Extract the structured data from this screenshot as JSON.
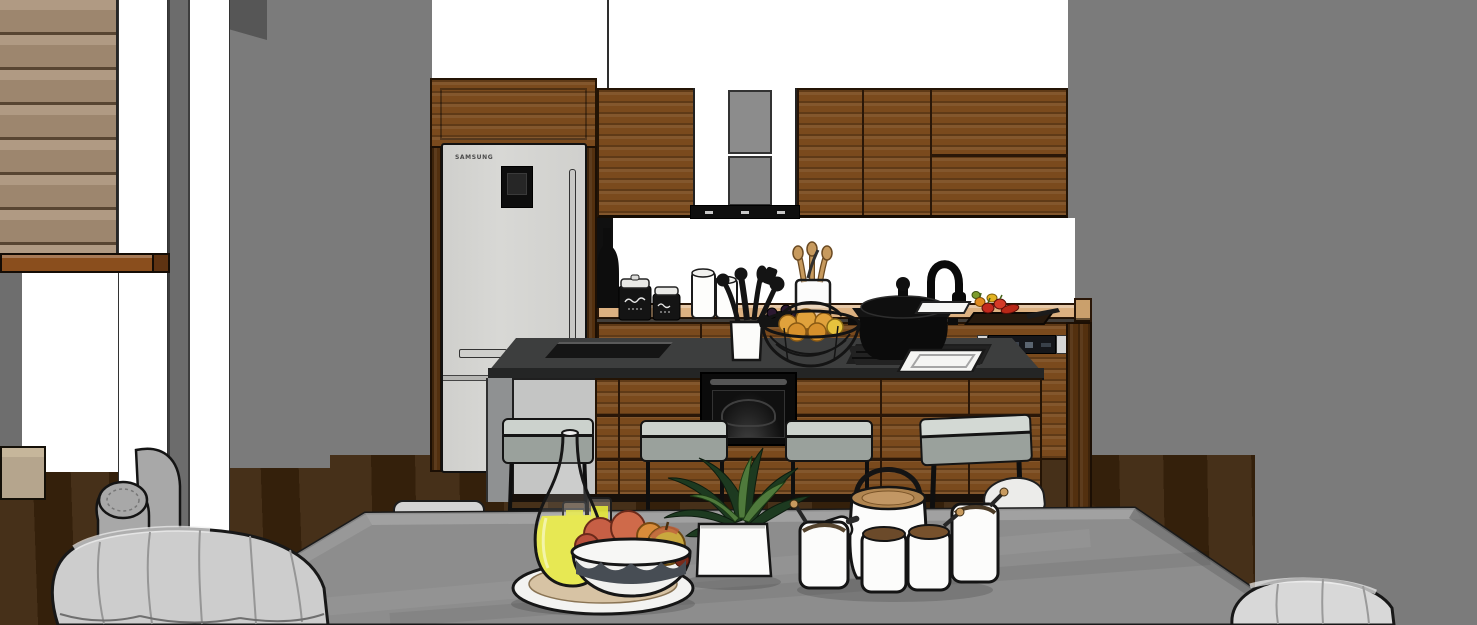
{
  "scene": {
    "title": "Kitchen interior 3D render",
    "style": "SketchUp-style architectural rendering of a modern kitchen with island, bar stools and dining table",
    "fridge": {
      "brand": "SAMSUNG"
    },
    "objects": [
      "wood slat accent wall",
      "white wall columns",
      "gray rolled-arm armchair",
      "beige sideboard",
      "Samsung double-door refrigerator",
      "tall wood cabinet",
      "upper wood cabinets",
      "range hood with gray duct",
      "white backsplash window",
      "wood countertop",
      "black canister jars with script labels",
      "white canisters",
      "utensil crock",
      "glass jar with wooden spoons",
      "wire fruit basket with oranges",
      "black cooking pot",
      "black gooseneck faucet",
      "cutting board with peppers",
      "built-in dishwasher control panel",
      "kitchen island with built-in oven",
      "four upholstered bar stools",
      "dark wood floor",
      "gray dining table",
      "glass lemonade carafe",
      "juice glasses",
      "scalloped fruit bowl with apples",
      "round white tray",
      "potted plant in white cube planter",
      "white jar set with wooden lids",
      "slip-covered dining chairs"
    ],
    "palette": {
      "wall": "#7b7b7b",
      "wall_dark": "#565656",
      "white": "#ffffff",
      "slat_wood": "#a78e75",
      "shelf_wood": "#8a4e1d",
      "wood": "#7a4a1d",
      "wood_dark": "#53300f",
      "wood_light": "#935f2a",
      "counter_top": "#dcb181",
      "island_top": "#3d3e3e",
      "island_side": "#8f9192",
      "island_panel": "#c4c5c4",
      "cushion": "#ccd2cd",
      "cushion_dark": "#9aa19c",
      "fridge_body": "#d8d8d5",
      "table_top": "#8d8d8d",
      "floor": "#3c250d",
      "chair_fabric": "#cdcdcd",
      "armchair_fabric": "#a8a8a8",
      "beige": "#b5a58d",
      "lemon": "#e3e537",
      "apple": "#c75f45",
      "orange_fruit": "#e0a23c",
      "leaf": "#1d3a20",
      "leaf_light": "#4f7a3c",
      "pepper_red": "#c32a1e",
      "pepper_orange": "#e08a1e",
      "pepper_green": "#7d9c2e",
      "lid_wood": "#b08550",
      "outline": "#1a1a1a"
    }
  }
}
